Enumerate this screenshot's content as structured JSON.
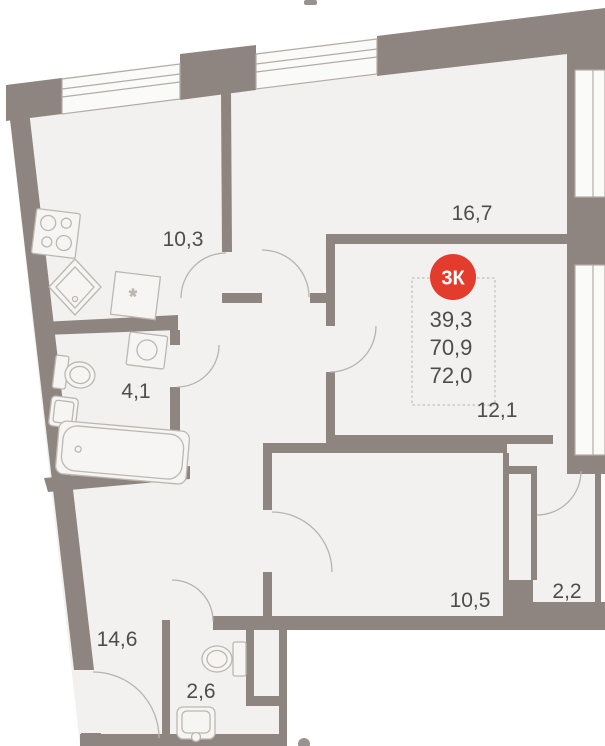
{
  "plan": {
    "type": "apartment-floor-plan",
    "legend": {
      "badge": "3К",
      "values": [
        "39,3",
        "70,9",
        "72,0"
      ]
    },
    "rooms": [
      {
        "id": "kitchen",
        "label": "10,3"
      },
      {
        "id": "living",
        "label": "16,7"
      },
      {
        "id": "bedroom-1",
        "label": "12,1"
      },
      {
        "id": "bathroom",
        "label": "4,1"
      },
      {
        "id": "hallway",
        "label": "14,6"
      },
      {
        "id": "wc",
        "label": "2,6"
      },
      {
        "id": "bedroom-2",
        "label": "10,5"
      },
      {
        "id": "storage",
        "label": "2,2"
      }
    ],
    "symbols": {
      "counter_star": "*"
    },
    "colors": {
      "wall": "#8e8580",
      "floor": "#f2f1ef",
      "glass": "#fafaf8",
      "fixture_line": "#b6b0aa",
      "text": "#4d4d4d",
      "badge": "#e33b2c",
      "legend_border": "#c4bfba"
    }
  }
}
